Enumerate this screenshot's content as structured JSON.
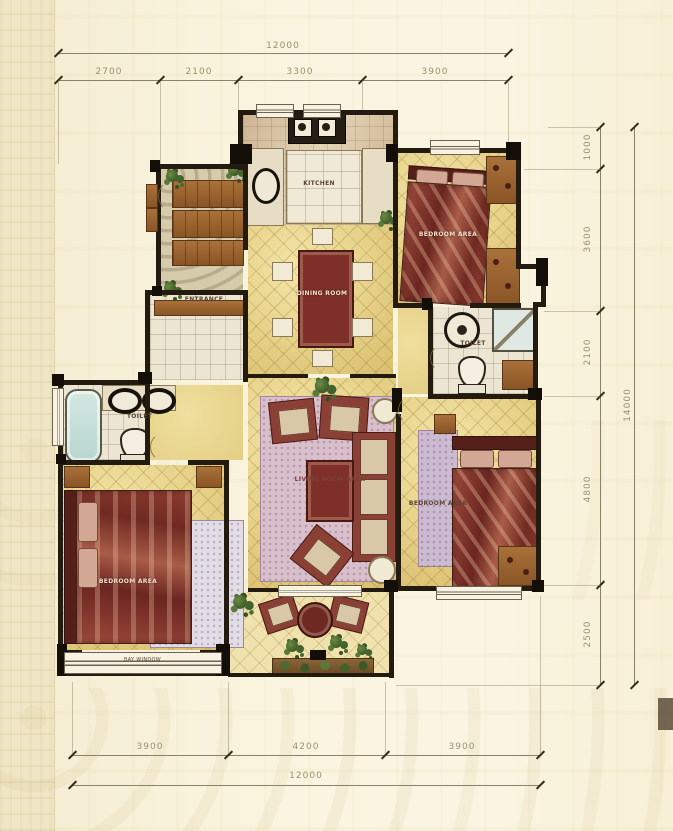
{
  "plan": {
    "title": "apartment-floor-plan",
    "dimensions": {
      "top": {
        "total": "12000",
        "segments": [
          "2700",
          "2100",
          "3300",
          "3900"
        ]
      },
      "right": {
        "total": "14000",
        "segments": [
          "1000",
          "3600",
          "2100",
          "4800",
          "2500"
        ]
      },
      "bottom": {
        "total": "12000",
        "segments": [
          "3900",
          "4200",
          "3900"
        ]
      }
    },
    "rooms": {
      "kitchen": {
        "label": "KITCHEN"
      },
      "entrance": {
        "label": "ENTRANCE"
      },
      "bedroom_top_right": {
        "label": "BEDROOM AREA"
      },
      "dining": {
        "label": "DINING ROOM"
      },
      "bath_right": {
        "label": "TOILET"
      },
      "living": {
        "label": "LIVING ROOM AREA"
      },
      "bedroom_bottom_right": {
        "label": "BEDROOM AREA"
      },
      "bath_left": {
        "label": "TOILET"
      },
      "bedroom_bottom_left": {
        "label": "BEDROOM AREA"
      },
      "bay_window": {
        "label": "BAY WINDOW"
      }
    },
    "colors": {
      "background": "#f8f1d9",
      "wall": "#241b10",
      "floor_gold": "#e5d086",
      "bed_red": "#82352c",
      "rug_pink": "#d9bfcc",
      "plant_green": "#4c6b33",
      "dimension_text": "#98916f"
    }
  }
}
